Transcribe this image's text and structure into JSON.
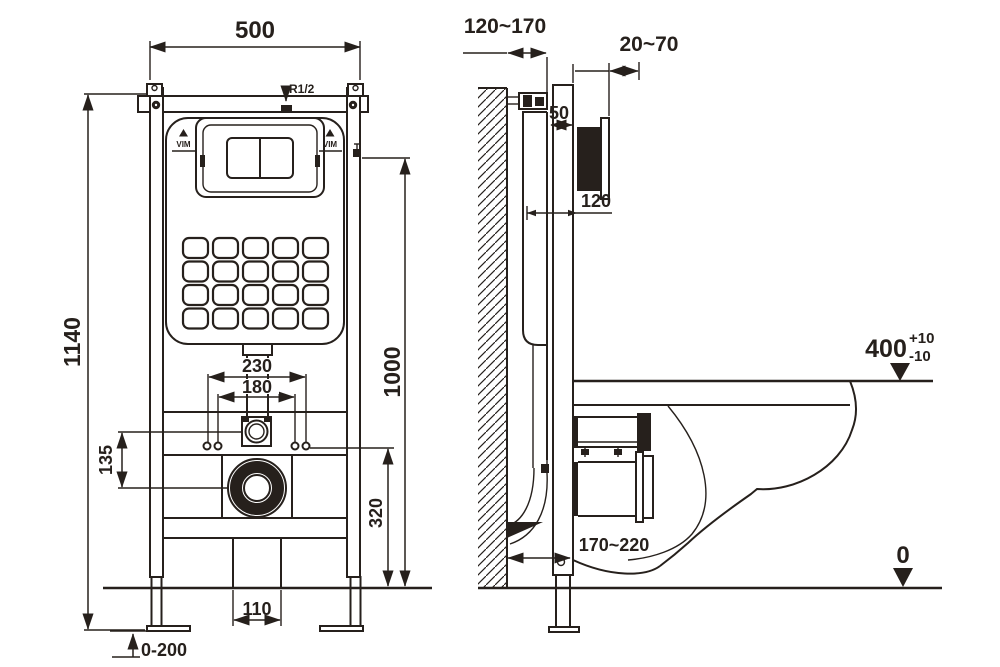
{
  "front_view": {
    "dims": {
      "width": "500",
      "total_height": "1140",
      "inlet_height": "1000",
      "drain_height": "320",
      "bolt_spacing_outer": "230",
      "bolt_spacing_inner": "180",
      "inlet_to_drain": "135",
      "duct_width": "110",
      "foot_adjustment": "0-200"
    },
    "labels": {
      "inlet_thread": "R1/2",
      "brand": "VIM"
    }
  },
  "side_view": {
    "dims": {
      "wall_depth_range": "120~170",
      "finish_thickness_range": "20~70",
      "rail_depth": "50",
      "plate_depth": "120",
      "outlet_offset_range": "170~220"
    },
    "levels": {
      "seat_height": "400",
      "seat_tol_plus": "+10",
      "seat_tol_minus": "-10",
      "floor": "0"
    }
  },
  "colors": {
    "line": "#26201c",
    "paper": "#ffffff"
  }
}
